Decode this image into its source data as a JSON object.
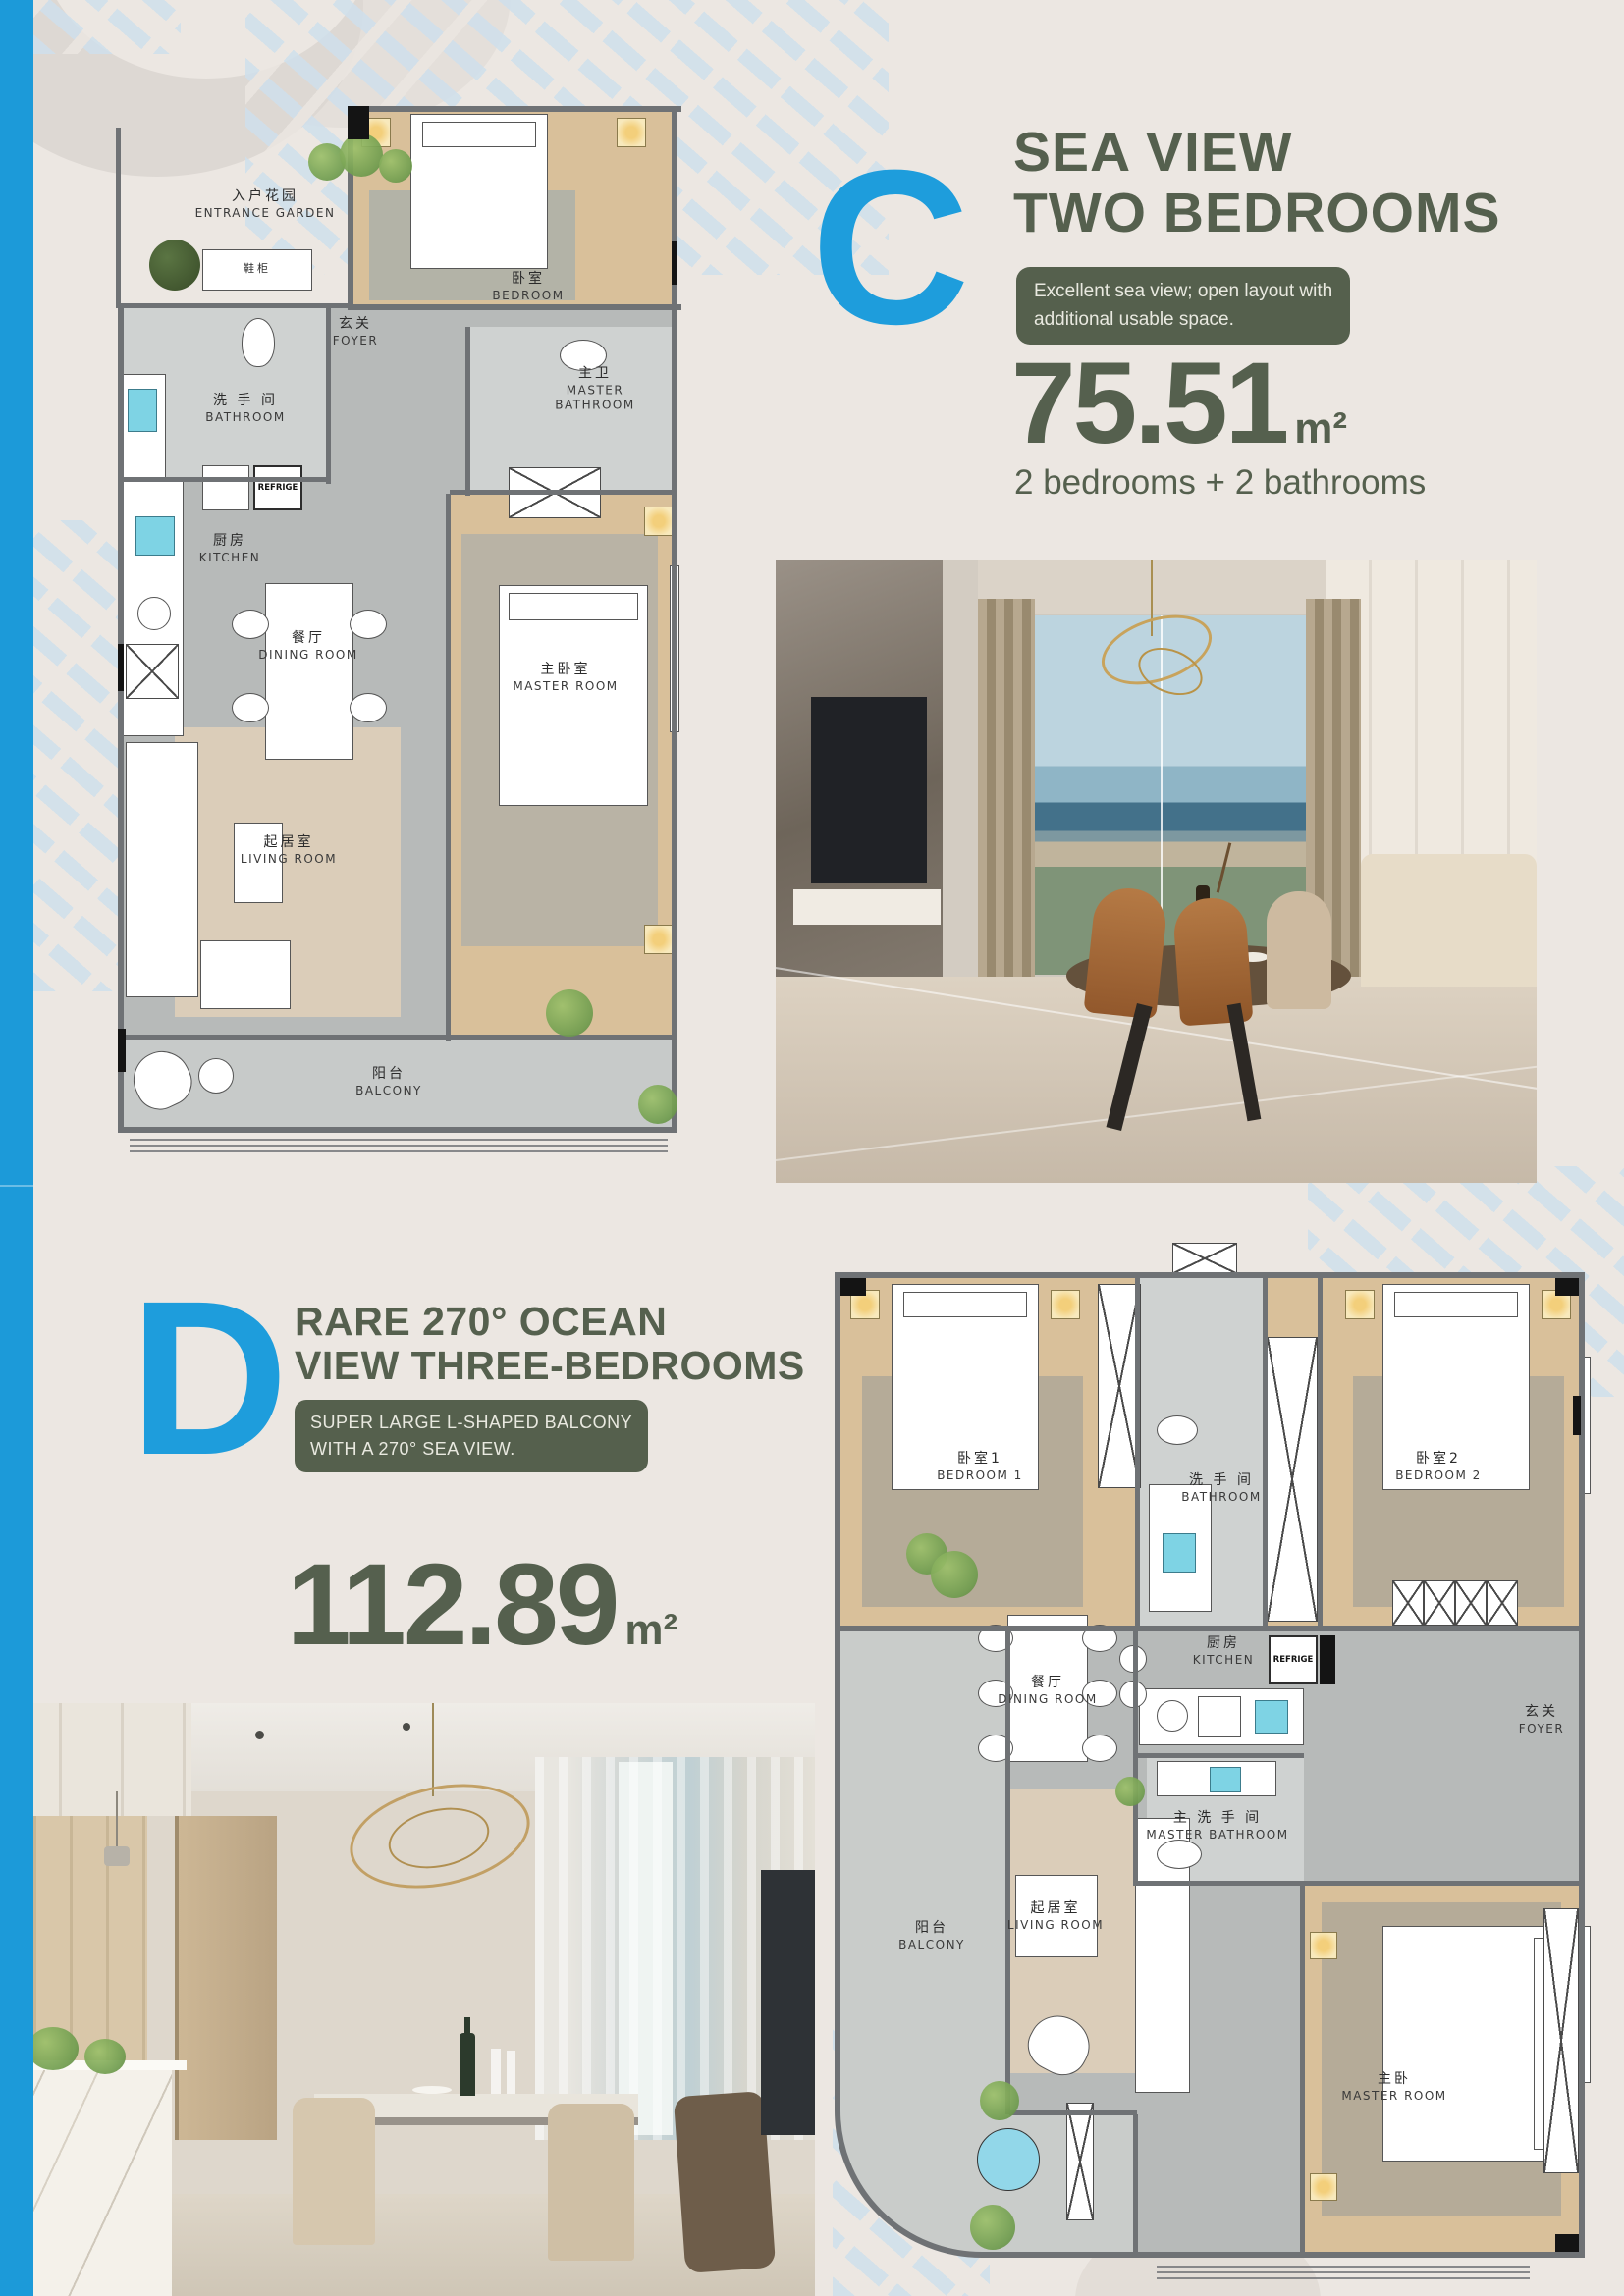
{
  "palette": {
    "page_bg": "#ECE7E2",
    "accent_blue": "#1E9DDC",
    "heading_green": "#55604E",
    "badge_green": "#55604D",
    "stripe_blue": "#CFE0EC"
  },
  "unit_c": {
    "letter": "C",
    "title_line1": "SEA VIEW",
    "title_line2": "TWO BEDROOMS",
    "badge_line1": "Excellent sea view; open layout with",
    "badge_line2": "additional usable space.",
    "area_value": "75.51",
    "area_unit": "m²",
    "config": "2 bedrooms + 2 bathrooms",
    "plan": {
      "entrance_garden_cn": "入户花园",
      "entrance_garden_en": "ENTRANCE GARDEN",
      "shoe_cabinet_cn": "鞋柜",
      "foyer_cn": "玄关",
      "foyer_en": "FOYER",
      "bedroom_cn": "卧室",
      "bedroom_en": "BEDROOM",
      "bathroom_cn": "洗 手 间",
      "bathroom_en": "BATHROOM",
      "master_bathroom_cn": "主卫",
      "master_bathroom_en": "MASTER BATHROOM",
      "kitchen_cn": "厨房",
      "kitchen_en": "KITCHEN",
      "dining_cn": "餐厅",
      "dining_en": "DINING ROOM",
      "living_cn": "起居室",
      "living_en": "LIVING ROOM",
      "master_room_cn": "主卧室",
      "master_room_en": "MASTER ROOM",
      "balcony_cn": "阳台",
      "balcony_en": "BALCONY",
      "refrigerator": "REFRIGE"
    }
  },
  "unit_d": {
    "letter": "D",
    "title_line1": "RARE 270° OCEAN",
    "title_line2": "VIEW THREE-BEDROOMS",
    "badge_line1": "SUPER LARGE L-SHAPED BALCONY",
    "badge_line2": "WITH A 270° SEA VIEW.",
    "area_value": "112.89",
    "area_unit": "m²",
    "plan": {
      "bedroom1_cn": "卧室1",
      "bedroom1_en": "BEDROOM 1",
      "bathroom_cn": "洗 手 间",
      "bathroom_en": "BATHROOM",
      "bedroom2_cn": "卧室2",
      "bedroom2_en": "BEDROOM 2",
      "foyer_cn": "玄关",
      "foyer_en": "FOYER",
      "dining_cn": "餐厅",
      "dining_en": "DINING ROOM",
      "kitchen_cn": "厨房",
      "kitchen_en": "KITCHEN",
      "master_bathroom_cn": "主 洗 手 间",
      "master_bathroom_en": "MASTER BATHROOM",
      "living_cn": "起居室",
      "living_en": "LIVING ROOM",
      "master_room_cn": "主卧",
      "master_room_en": "MASTER ROOM",
      "balcony_cn": "阳台",
      "balcony_en": "BALCONY",
      "refrigerator": "REFRIGE"
    }
  }
}
